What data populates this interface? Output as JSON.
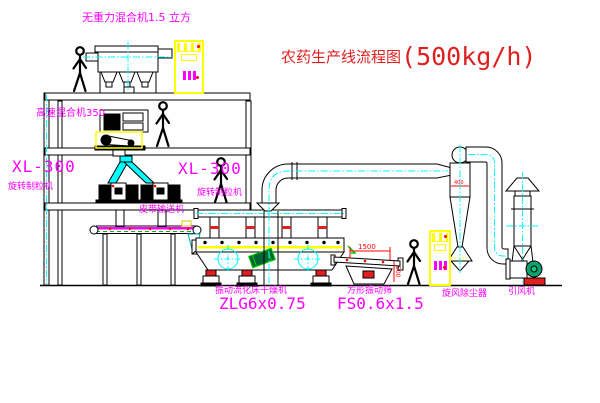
{
  "title": {
    "name": "农药生产线流程图",
    "capacity": "(500kg/h)"
  },
  "labels": {
    "gravityless_mixer": "无重力混合机1.5 立方",
    "high_speed_mixer": "高速混合机350",
    "granulator_left": {
      "model": "XL-300",
      "name": "旋转制粒机"
    },
    "granulator_right": {
      "model": "XL-300",
      "name": "旋转制粒机"
    },
    "belt_conveyor": "皮带输送机",
    "dryer": {
      "name": "振动流化床干燥机",
      "model": "ZLG6x0.75"
    },
    "screen": {
      "name": "方形振动筛",
      "model": "FS0.6x1.5"
    },
    "cyclone": "旋风除尘器",
    "induced_fan": "引风机"
  },
  "dimensions": {
    "screen_length": "1500",
    "screen_height": "500",
    "cyclone_note": "400"
  },
  "colors": {
    "line": "#000000",
    "centerline": "#00ffff",
    "label_magenta": "#ff00ff",
    "title_red": "#e02020",
    "cabinet_yellow": "#ffff00",
    "conveyor_green": "#00bb00",
    "damper_red": "#e02020",
    "motor_teal": "#10a070"
  }
}
